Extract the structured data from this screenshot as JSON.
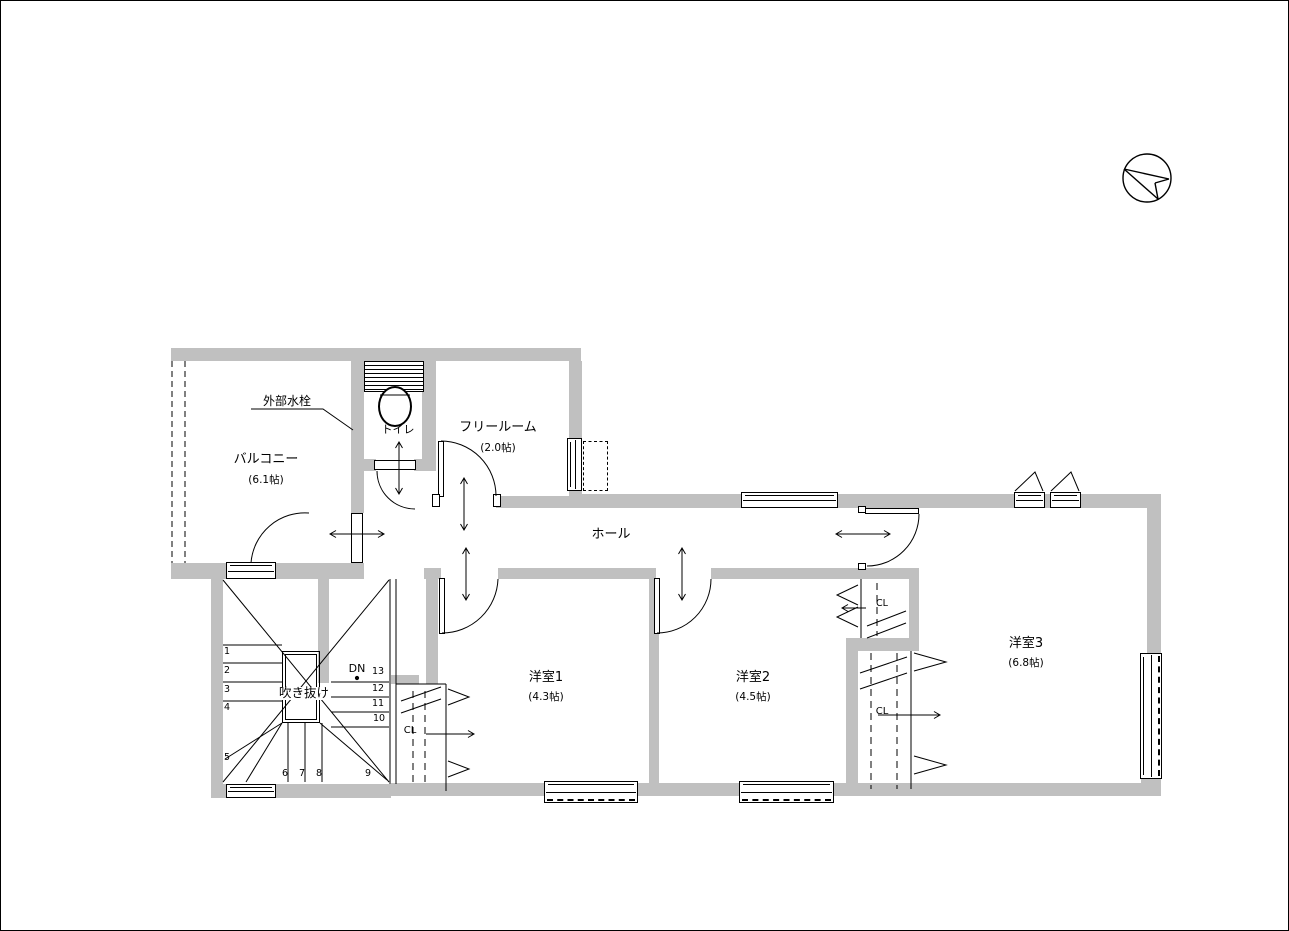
{
  "rooms": {
    "balcony": {
      "name": "バルコニー",
      "area": "(6.1帖)"
    },
    "toilet": {
      "name": "トイレ"
    },
    "free_room": {
      "name": "フリールーム",
      "area": "(2.0帖)"
    },
    "hall": {
      "name": "ホール"
    },
    "void": {
      "name": "吹き抜け"
    },
    "western_room_1": {
      "name": "洋室1",
      "area": "(4.3帖)"
    },
    "western_room_2": {
      "name": "洋室2",
      "area": "(4.5帖)"
    },
    "western_room_3": {
      "name": "洋室3",
      "area": "(6.8帖)"
    }
  },
  "annotations": {
    "exterior_faucet": "外部水栓",
    "down_label": "DN",
    "closet_room1": "CL",
    "closet_room2": "CL",
    "closet_room3": "CL"
  },
  "stairs": {
    "step_numbers": [
      "1",
      "2",
      "3",
      "4",
      "5",
      "6",
      "7",
      "8",
      "9",
      "10",
      "11",
      "12",
      "13"
    ]
  },
  "colors": {
    "wall_fill": "#c0c0c0",
    "line": "#000000",
    "background": "#ffffff"
  }
}
